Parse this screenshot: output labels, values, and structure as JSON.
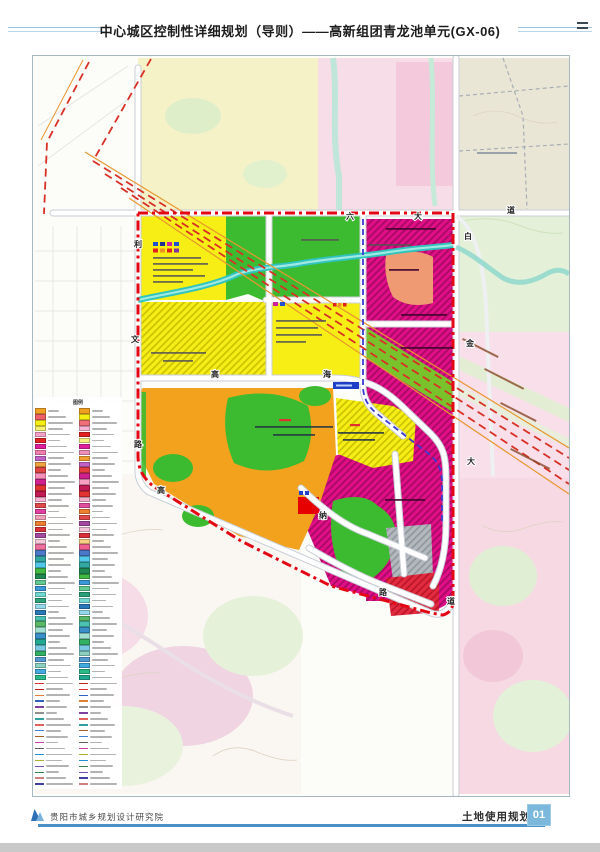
{
  "title": "中心城区控制性详细规划（导则）——高新组团青龙池单元(GX-06)",
  "footer": {
    "org": "贵阳市城乡规划设计研究院",
    "map_title": "土地使用规划图",
    "page_no": "01"
  },
  "legend": {
    "title": "图例",
    "col1": [
      "#f2a024",
      "#ef5f68",
      "#f7ee13",
      "#f7f06e",
      "#f6a3c9",
      "#e32222",
      "#e01f9e",
      "#f07fb0",
      "#c262c4",
      "#f0a340",
      "#e04343",
      "#f78fba",
      "#d0218f",
      "#e23333",
      "#c21a52",
      "#f8b2d2",
      "#e04a4a",
      "#e23fa2",
      "#f0a2ba",
      "#ef7f31",
      "#d93039",
      "#a449a0",
      "#f6c9da",
      "#ee6f9f",
      "#4a79c9",
      "#32a8a2",
      "#52c9e9",
      "#41b943",
      "#218852",
      "#62c992",
      "#3a99d9",
      "#72d9d2",
      "#2aa179",
      "#92d9e9",
      "#2979b9",
      "#4ac1b1",
      "#59b969",
      "#a2e1d1",
      "#3a91c9",
      "#22a992",
      "#79c9e1",
      "#32b162",
      "#5299d1",
      "#8ad1c1",
      "#42a9e1",
      "#2ab989",
      "#e03030",
      "#c02020",
      "#e08030",
      "#3060c0",
      "#8040a0",
      "#909090",
      "#30a0a0",
      "#e06060",
      "#4080d0",
      "#a06030",
      "#d040a0",
      "#606060",
      "#2090d0",
      "#b0b030",
      "#7050b0",
      "#308050",
      "#d08080",
      "#4040a0"
    ],
    "col2": [
      "#f0a020",
      "#f7ee13",
      "#ef6f78",
      "#f6b3d3",
      "#e22222",
      "#f7f080",
      "#e01f9e",
      "#ef8fb8",
      "#f0a030",
      "#c262c4",
      "#e23f3f",
      "#d0218f",
      "#f79fc2",
      "#c21a52",
      "#e23333",
      "#f0b0cc",
      "#e24f9f",
      "#ef7f31",
      "#e04a4a",
      "#a449a0",
      "#f2c3d6",
      "#d93039",
      "#f6d083",
      "#ee5f8f",
      "#4a79c9",
      "#52c9e9",
      "#32a8a2",
      "#218852",
      "#41b943",
      "#3a99d9",
      "#62c992",
      "#2aa179",
      "#72d9d2",
      "#2979b9",
      "#92d9e9",
      "#59b969",
      "#4ac1b1",
      "#3a91c9",
      "#a2e1d1",
      "#32b162",
      "#79c9e1",
      "#8ad1c1",
      "#5299d1",
      "#42a9e1",
      "#2ab989",
      "#22a992",
      "#c02020",
      "#e03030",
      "#3060c0",
      "#e08030",
      "#909090",
      "#8040a0",
      "#e06060",
      "#30a0a0",
      "#a06030",
      "#4080d0",
      "#606060",
      "#d040a0",
      "#b0b030",
      "#2090d0",
      "#308050",
      "#7050b0",
      "#4040a0",
      "#d08080"
    ]
  },
  "map": {
    "palette": {
      "boundary": "#e30613",
      "roadCase": "#c9ced6",
      "roadFill": "#ffffff",
      "yellow": "#f6ee14",
      "green": "#3dbb30",
      "magenta": "#e10f87",
      "orange": "#f2a21c",
      "salmon": "#f09a74",
      "corridor": "#79c22c",
      "river": "#2fc4bc",
      "redZone": "#e22b3e",
      "grayZone": "#b3b8bd",
      "metro": "#3b3bd0",
      "railway": "#d93025",
      "railwayOrange": "#e8962e",
      "ctxYellow": "#f4f0bf",
      "ctxPink": "#f7dbe6",
      "ctxPinkDeep": "#f3c6d9",
      "ctxGreen": "#e4f1d8",
      "ctxTan": "#eae6d6",
      "accentBlue": "#4a90c8",
      "badgeBlue": "#7cb8dc",
      "titleRule": "#9cc6e0"
    },
    "road_labels": [
      {
        "t": "六",
        "x": 313,
        "y": 163
      },
      {
        "t": "大",
        "x": 381,
        "y": 163
      },
      {
        "t": "道",
        "x": 474,
        "y": 157
      },
      {
        "t": "白",
        "x": 431,
        "y": 183
      },
      {
        "t": "金",
        "x": 433,
        "y": 290
      },
      {
        "t": "大",
        "x": 434,
        "y": 408
      },
      {
        "t": "道",
        "x": 414,
        "y": 548
      },
      {
        "t": "利",
        "x": 101,
        "y": 191
      },
      {
        "t": "文",
        "x": 98,
        "y": 286
      },
      {
        "t": "路",
        "x": 101,
        "y": 391
      },
      {
        "t": "高",
        "x": 178,
        "y": 321
      },
      {
        "t": "海",
        "x": 290,
        "y": 321
      },
      {
        "t": "高",
        "x": 124,
        "y": 437
      },
      {
        "t": "纳",
        "x": 286,
        "y": 462
      },
      {
        "t": "路",
        "x": 346,
        "y": 539
      }
    ]
  }
}
